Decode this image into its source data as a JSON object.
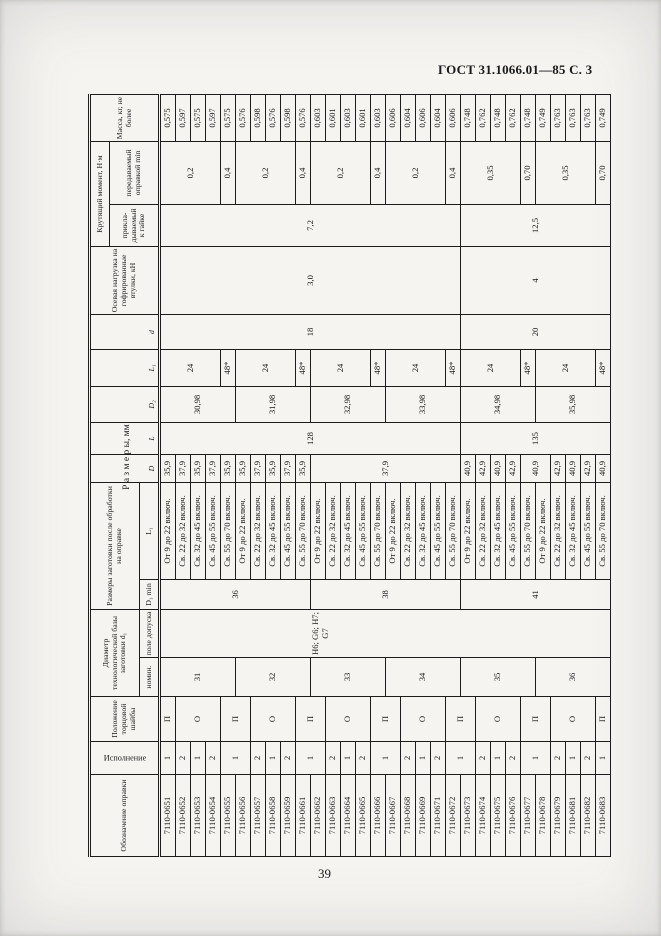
{
  "page": {
    "doc_header": "ГОСТ 31.1066.01—85 С. 3",
    "page_number": "39",
    "table_title": "Р а з м е р ы,  мм",
    "colors": {
      "ink": "#1a1a1a",
      "paper": "#f5f4f1"
    }
  },
  "table": {
    "headers": {
      "designation": "Обозначение оправки",
      "execution": "Исполнение",
      "washer_position": "Положение торцовой шайбы",
      "diameter_base": "Диаметр технологической базы заготовки d₁",
      "diameter_nominal": "номин.",
      "diameter_tolerance": "поле допуска",
      "blank_dims": "Размеры заготовки после обработки на оправке",
      "d1_min": "D₁ min",
      "l1_range": "L₁",
      "col_D": "D",
      "col_L": "L",
      "col_D2": "D₂",
      "col_L1": "L₁",
      "col_d": "d",
      "axial_load": "Осевая нагрузка на гофриро­ванные втулки, кН",
      "torque": "Крутящий момент, Н·м",
      "torque_applied": "прикла­дывае­мый к гайке",
      "torque_transmitted": "передавае­мый оправкой min",
      "mass": "Масса, кг, не более"
    },
    "body": [
      [
        "7110-0651",
        "1",
        "П",
        {
          "v": "31",
          "rs": 5
        },
        {
          "v": "Н6; G6; Н7; G7",
          "rs": 30,
          "cls": "pole"
        },
        {
          "v": "36",
          "rs": 10
        },
        {
          "v": "От 9 до 22 включ.",
          "cls": "rng"
        },
        "35,9",
        {
          "v": "128",
          "rs": 20
        },
        {
          "v": "30,98",
          "rs": 5
        },
        {
          "v": "24",
          "rs": 4
        },
        {
          "v": "18",
          "rs": 20
        },
        {
          "v": "3,0",
          "rs": 20
        },
        {
          "v": "7,2",
          "rs": 20
        },
        {
          "v": "0,2",
          "rs": 4
        },
        "0,575"
      ],
      [
        "7110-0652",
        "2",
        {
          "v": "О",
          "rs": 3
        },
        {
          "v": "Св. 22 до 32 включ.",
          "cls": "rng"
        },
        "37,9",
        "0,597"
      ],
      [
        "7110-0653",
        "1",
        {
          "v": "Св. 32 до 45 включ.",
          "cls": "rng"
        },
        "35,9",
        "0,575"
      ],
      [
        "7110-0654",
        "2",
        {
          "v": "Св. 45 до 55 включ.",
          "cls": "rng"
        },
        "37,9",
        "0,597"
      ],
      [
        "7110-0655",
        {
          "v": "1",
          "rs": 2
        },
        {
          "v": "П",
          "rs": 2
        },
        {
          "v": "Св. 55 до 70 включ.",
          "cls": "rng"
        },
        "35,9",
        "48*",
        "0,4",
        "0,575"
      ],
      [
        "7110-0656",
        {
          "v": "32",
          "rs": 5
        },
        {
          "v": "От 9 до 22 включ.",
          "cls": "rng"
        },
        "35,9",
        {
          "v": "31,98",
          "rs": 5
        },
        {
          "v": "24",
          "rs": 4
        },
        {
          "v": "0,2",
          "rs": 4
        },
        "0,576"
      ],
      [
        "7110-0657",
        "2",
        {
          "v": "О",
          "rs": 3
        },
        {
          "v": "Св. 22 до 32 включ.",
          "cls": "rng"
        },
        "37,9",
        "0,598"
      ],
      [
        "7110-0658",
        "1",
        {
          "v": "Св. 32 до 45 включ.",
          "cls": "rng"
        },
        "35,9",
        "0,576"
      ],
      [
        "7110-0659",
        "2",
        {
          "v": "Св. 45 до 55 включ.",
          "cls": "rng"
        },
        "37,9",
        "0,598"
      ],
      [
        "7110-0661",
        {
          "v": "1",
          "rs": 2
        },
        {
          "v": "П",
          "rs": 2
        },
        {
          "v": "Св. 55 до 70 включ.",
          "cls": "rng"
        },
        "35,9",
        "48*",
        "0,4",
        "0,576"
      ],
      [
        "7110-0662",
        {
          "v": "33",
          "rs": 5
        },
        {
          "v": "38",
          "rs": 10
        },
        {
          "v": "От 9 до 22 включ.",
          "cls": "rng"
        },
        {
          "v": "37,9",
          "rs": 10
        },
        {
          "v": "32,98",
          "rs": 5
        },
        {
          "v": "24",
          "rs": 4
        },
        {
          "v": "0,2",
          "rs": 4
        },
        "0,603"
      ],
      [
        "7110-0663",
        "2",
        {
          "v": "О",
          "rs": 3
        },
        {
          "v": "Св. 22 до 32 включ.",
          "cls": "rng"
        },
        "0,601"
      ],
      [
        "7110-0664",
        "1",
        {
          "v": "Св. 32 до 45 включ.",
          "cls": "rng"
        },
        "0,603"
      ],
      [
        "7110-0665",
        "2",
        {
          "v": "Св. 45 до 55 включ.",
          "cls": "rng"
        },
        "0,601"
      ],
      [
        "7110-0666",
        {
          "v": "1",
          "rs": 2
        },
        {
          "v": "П",
          "rs": 2
        },
        {
          "v": "Св. 55 до 70 включ.",
          "cls": "rng"
        },
        "48*",
        "0,4",
        "0,603"
      ],
      [
        "7110-0667",
        {
          "v": "34",
          "rs": 5
        },
        {
          "v": "От 9 до 22 включ.",
          "cls": "rng"
        },
        {
          "v": "33,98",
          "rs": 5
        },
        {
          "v": "24",
          "rs": 4
        },
        {
          "v": "0,2",
          "rs": 4
        },
        "0,606"
      ],
      [
        "7110-0668",
        "2",
        {
          "v": "О",
          "rs": 3
        },
        {
          "v": "Св. 22 до 32 включ.",
          "cls": "rng"
        },
        "0,604"
      ],
      [
        "7110-0669",
        "1",
        {
          "v": "Св. 32 до 45 включ.",
          "cls": "rng"
        },
        "0,606"
      ],
      [
        "7110-0671",
        "2",
        {
          "v": "Св. 45 до 55 включ.",
          "cls": "rng"
        },
        "0,604"
      ],
      [
        "7110-0672",
        {
          "v": "1",
          "rs": 2
        },
        {
          "v": "П",
          "rs": 2
        },
        {
          "v": "Св. 55 до 70 включ.",
          "cls": "rng"
        },
        "48*",
        "0,4",
        "0,606"
      ],
      [
        "7110-0673",
        {
          "v": "35",
          "rs": 5
        },
        {
          "v": "41",
          "rs": 10
        },
        {
          "v": "От 9 до 22 включ.",
          "cls": "rng"
        },
        "40,9",
        {
          "v": "135",
          "rs": 10
        },
        {
          "v": "34,98",
          "rs": 5
        },
        {
          "v": "24",
          "rs": 4
        },
        {
          "v": "20",
          "rs": 10
        },
        {
          "v": "4",
          "rs": 10
        },
        {
          "v": "12,5",
          "rs": 10
        },
        {
          "v": "0,35",
          "rs": 4
        },
        "0,748"
      ],
      [
        "7110-0674",
        "2",
        {
          "v": "О",
          "rs": 3
        },
        {
          "v": "Св. 22 до 32 включ.",
          "cls": "rng"
        },
        "42,9",
        "0,762"
      ],
      [
        "7110-0675",
        "1",
        {
          "v": "Св. 32 до 45 включ.",
          "cls": "rng"
        },
        "40,9",
        "0,748"
      ],
      [
        "7110-0676",
        "2",
        {
          "v": "Св. 45 до 55 включ.",
          "cls": "rng"
        },
        "42,9",
        "0,762"
      ],
      [
        "7110-0677",
        {
          "v": "1",
          "rs": 2
        },
        {
          "v": "П",
          "rs": 2
        },
        {
          "v": "Св. 55 до 70 включ.",
          "cls": "rng"
        },
        {
          "v": "40,9",
          "rs": 2
        },
        "48*",
        "0,70",
        "0,748"
      ],
      [
        "7110-0678",
        {
          "v": "36",
          "rs": 5
        },
        {
          "v": "От 9 до 22 включ.",
          "cls": "rng"
        },
        {
          "v": "35,98",
          "rs": 5
        },
        {
          "v": "24",
          "rs": 4
        },
        {
          "v": "0,35",
          "rs": 4
        },
        "0,749"
      ],
      [
        "7110-0679",
        "2",
        {
          "v": "О",
          "rs": 3
        },
        {
          "v": "Св. 22 до 32 включ.",
          "cls": "rng"
        },
        "42,9",
        "0,763"
      ],
      [
        "7110-0681",
        "1",
        {
          "v": "Св. 32 до 45 включ.",
          "cls": "rng"
        },
        "40,9",
        "0,763"
      ],
      [
        "7110-0682",
        "2",
        {
          "v": "Св. 45 до 55 включ.",
          "cls": "rng"
        },
        "42,9",
        "0,763"
      ],
      [
        "7110-0683",
        "1",
        "П",
        {
          "v": "Св. 55 до 70 включ.",
          "cls": "rng"
        },
        "40,9",
        "48*",
        "0,70",
        "0,749"
      ]
    ]
  }
}
